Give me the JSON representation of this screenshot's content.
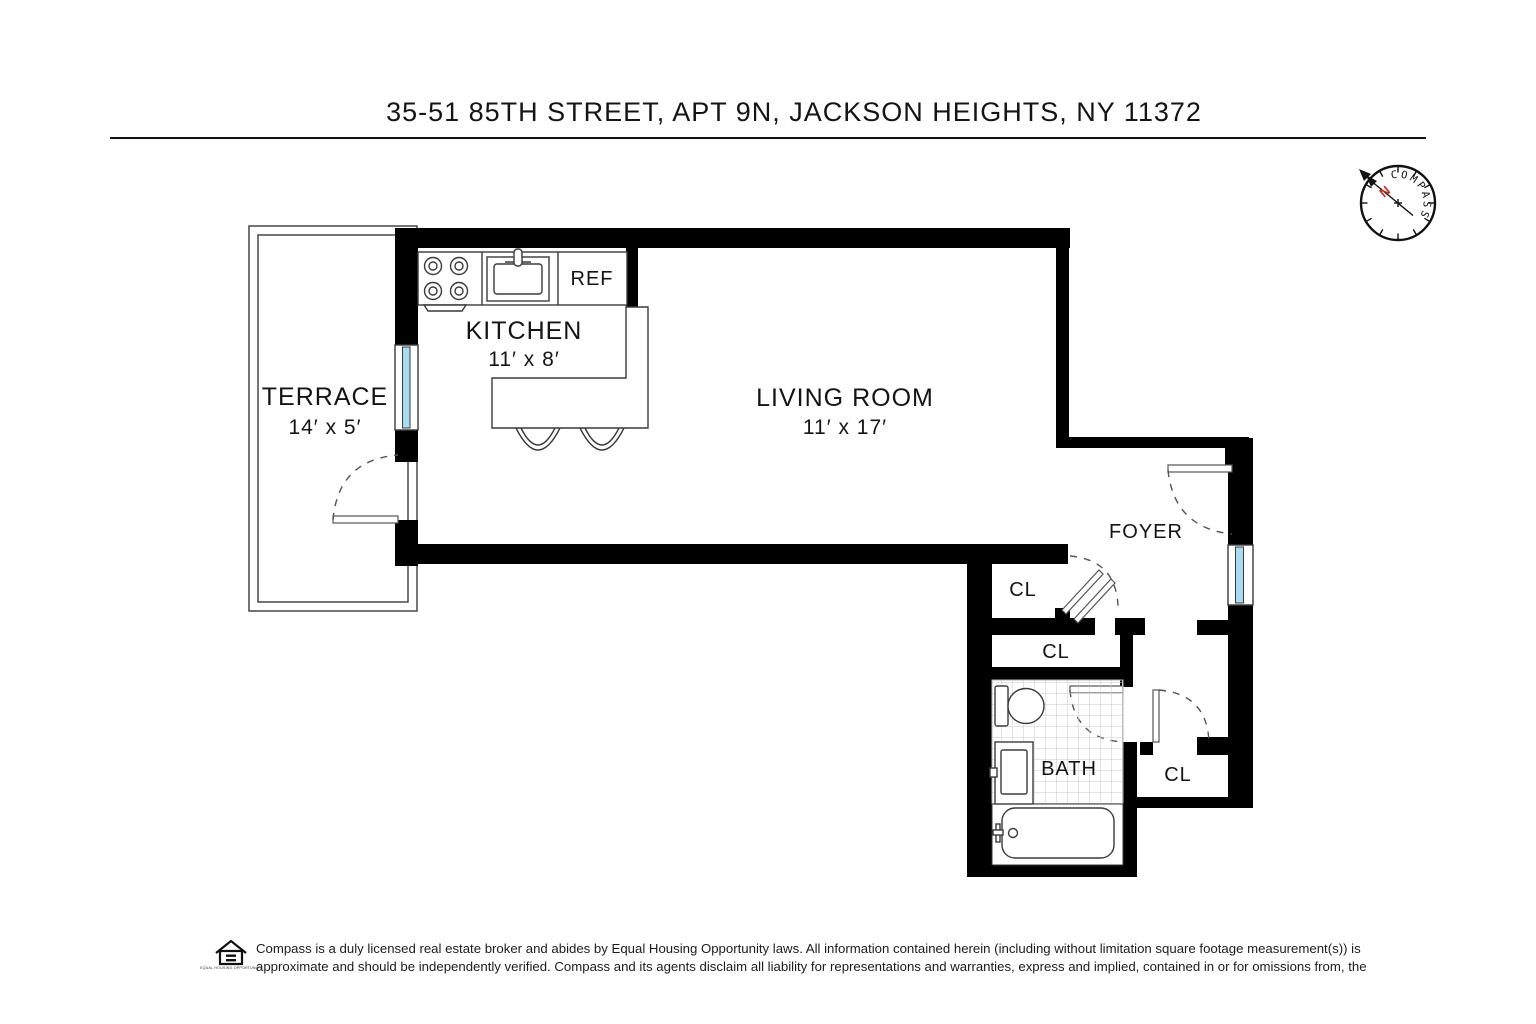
{
  "page": {
    "title": "35-51 85TH STREET, APT 9N, JACKSON HEIGHTS, NY 11372"
  },
  "compass": {
    "label": "COMPASS",
    "north": "N"
  },
  "rooms": {
    "terrace": {
      "name": "TERRACE",
      "dims": "14′ x 5′"
    },
    "kitchen": {
      "name": "KITCHEN",
      "dims": "11′ x 8′"
    },
    "living_room": {
      "name": "LIVING ROOM",
      "dims": "11′ x 17′"
    },
    "foyer": {
      "name": "FOYER"
    },
    "bath": {
      "name": "BATH"
    },
    "closet_foyer": {
      "name": "CL"
    },
    "closet_hall": {
      "name": "CL"
    },
    "closet_corner": {
      "name": "CL"
    }
  },
  "fixtures": {
    "refrigerator": "REF"
  },
  "colors": {
    "wall": "#000000",
    "window_glass": "#a9dcf3",
    "needle_north": "#c03126"
  },
  "footer": {
    "line1": "Compass is a duly licensed real estate broker and abides by Equal Housing Opportunity laws. All information contained herein (including without limitation square footage measurement(s)) is",
    "line2": "approximate and should be independently verified. Compass and its agents disclaim all liability for representations and warranties, express and implied, contained in or for omissions from, the",
    "eho_caption": "EQUAL HOUSING OPPORTUNITY"
  }
}
